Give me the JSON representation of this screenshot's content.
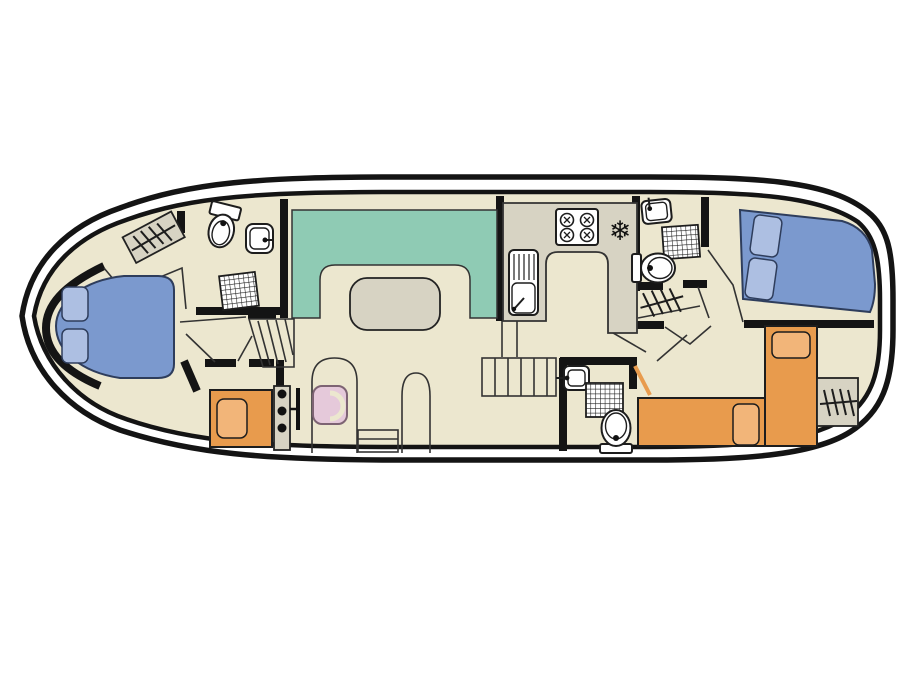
{
  "diagram": {
    "kind": "houseboat-deck-plan",
    "title": "Boat interior layout plan",
    "colors": {
      "background": "#ffffff",
      "hull": "#141414",
      "wall": "#141414",
      "line": "#333333",
      "floor": "#ece7cf",
      "bench": "#8fcbb4",
      "counter": "#d7d3c3",
      "fixture": "#ffffff",
      "double_bed": "#7b99ce",
      "double_pillow": "#adbfe2",
      "single_bed": "#e89b4d",
      "single_pillow": "#f2b579",
      "seat": "#e5c9da"
    },
    "regions": [
      {
        "id": "bow-double-cabin",
        "label": "bow double cabin"
      },
      {
        "id": "forward-bathroom",
        "label": "forward bathroom with shower"
      },
      {
        "id": "forward-single-cabin",
        "label": "forward single cabin"
      },
      {
        "id": "saloon-dinette",
        "label": "saloon U-shaped dinette with table"
      },
      {
        "id": "galley",
        "label": "galley kitchen"
      },
      {
        "id": "mid-bathroom",
        "label": "midship bathroom with shower"
      },
      {
        "id": "aft-bathroom",
        "label": "aft bathroom with shower"
      },
      {
        "id": "aft-double-cabin",
        "label": "aft double cabin"
      },
      {
        "id": "aft-twin-cabin",
        "label": "aft twin single cabin"
      },
      {
        "id": "helm-station",
        "label": "inside steering position"
      }
    ],
    "furniture": [
      {
        "id": "bow-double-bed",
        "label": "double bed with two pillows"
      },
      {
        "id": "fwd-wardrobe",
        "label": "hanging wardrobe"
      },
      {
        "id": "fwd-toilet",
        "label": "toilet"
      },
      {
        "id": "fwd-washbasin",
        "label": "washbasin"
      },
      {
        "id": "fwd-shower",
        "label": "shower tray"
      },
      {
        "id": "fwd-single-bed",
        "label": "single bed with pillow"
      },
      {
        "id": "fwd-stairs",
        "label": "steps down to forward cabins"
      },
      {
        "id": "dinette-bench",
        "label": "U-shaped seating bench"
      },
      {
        "id": "dinette-table",
        "label": "saloon table"
      },
      {
        "id": "galley-counter",
        "label": "U-shaped worktop"
      },
      {
        "id": "galley-hob",
        "label": "four burner hob"
      },
      {
        "id": "galley-fridge",
        "label": "fridge freezer (snowflake)"
      },
      {
        "id": "galley-sink",
        "label": "sink with drainer"
      },
      {
        "id": "mid-stairs",
        "label": "steps down to aft cabins"
      },
      {
        "id": "mid-washbasin",
        "label": "washbasin"
      },
      {
        "id": "mid-shower",
        "label": "shower tray"
      },
      {
        "id": "mid-toilet",
        "label": "toilet"
      },
      {
        "id": "aft-washbasin",
        "label": "washbasin"
      },
      {
        "id": "aft-shower",
        "label": "shower tray"
      },
      {
        "id": "aft-toilet",
        "label": "toilet"
      },
      {
        "id": "aft-wardrobe-upper",
        "label": "hanging wardrobe"
      },
      {
        "id": "aft-double-bed",
        "label": "double bed with two pillows"
      },
      {
        "id": "aft-single-bed-1",
        "label": "single bed with pillow"
      },
      {
        "id": "aft-single-bed-2",
        "label": "single bed with pillow"
      },
      {
        "id": "stern-wardrobe",
        "label": "hanging wardrobe"
      },
      {
        "id": "helm-console",
        "label": "steering console with instruments"
      },
      {
        "id": "helm-throttle",
        "label": "throttle lever"
      },
      {
        "id": "helm-seat",
        "label": "helm seat"
      },
      {
        "id": "helm-bench",
        "label": "small bench/step"
      },
      {
        "id": "side-door-1",
        "label": "side door opening"
      },
      {
        "id": "side-door-2",
        "label": "side door opening"
      }
    ]
  }
}
